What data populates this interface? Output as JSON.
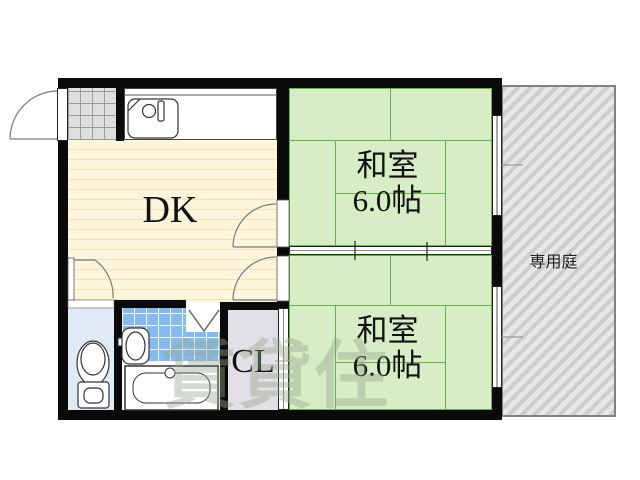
{
  "rooms": {
    "dk": {
      "label": "DK"
    },
    "washitsu_upper": {
      "name": "和室",
      "size": "6.0帖"
    },
    "washitsu_lower": {
      "name": "和室",
      "size": "6.0帖"
    },
    "closet": {
      "label": "CL"
    },
    "garden": {
      "label": "専用庭"
    }
  },
  "watermark": "賃貸住",
  "colors": {
    "wall": "#0a0a0a",
    "tatami_fill": "#d6edc6",
    "tatami_line": "#67b14a",
    "dk_floor": "#fdf6dc",
    "dk_stripe": "#f2e3b0",
    "bath_tile": "#86baee",
    "toilet_floor": "#dfeaf6",
    "closet_fill": "#e3dfe7",
    "genkan_tile": "#dedede",
    "garden_hatch": "#cdcdcd"
  }
}
